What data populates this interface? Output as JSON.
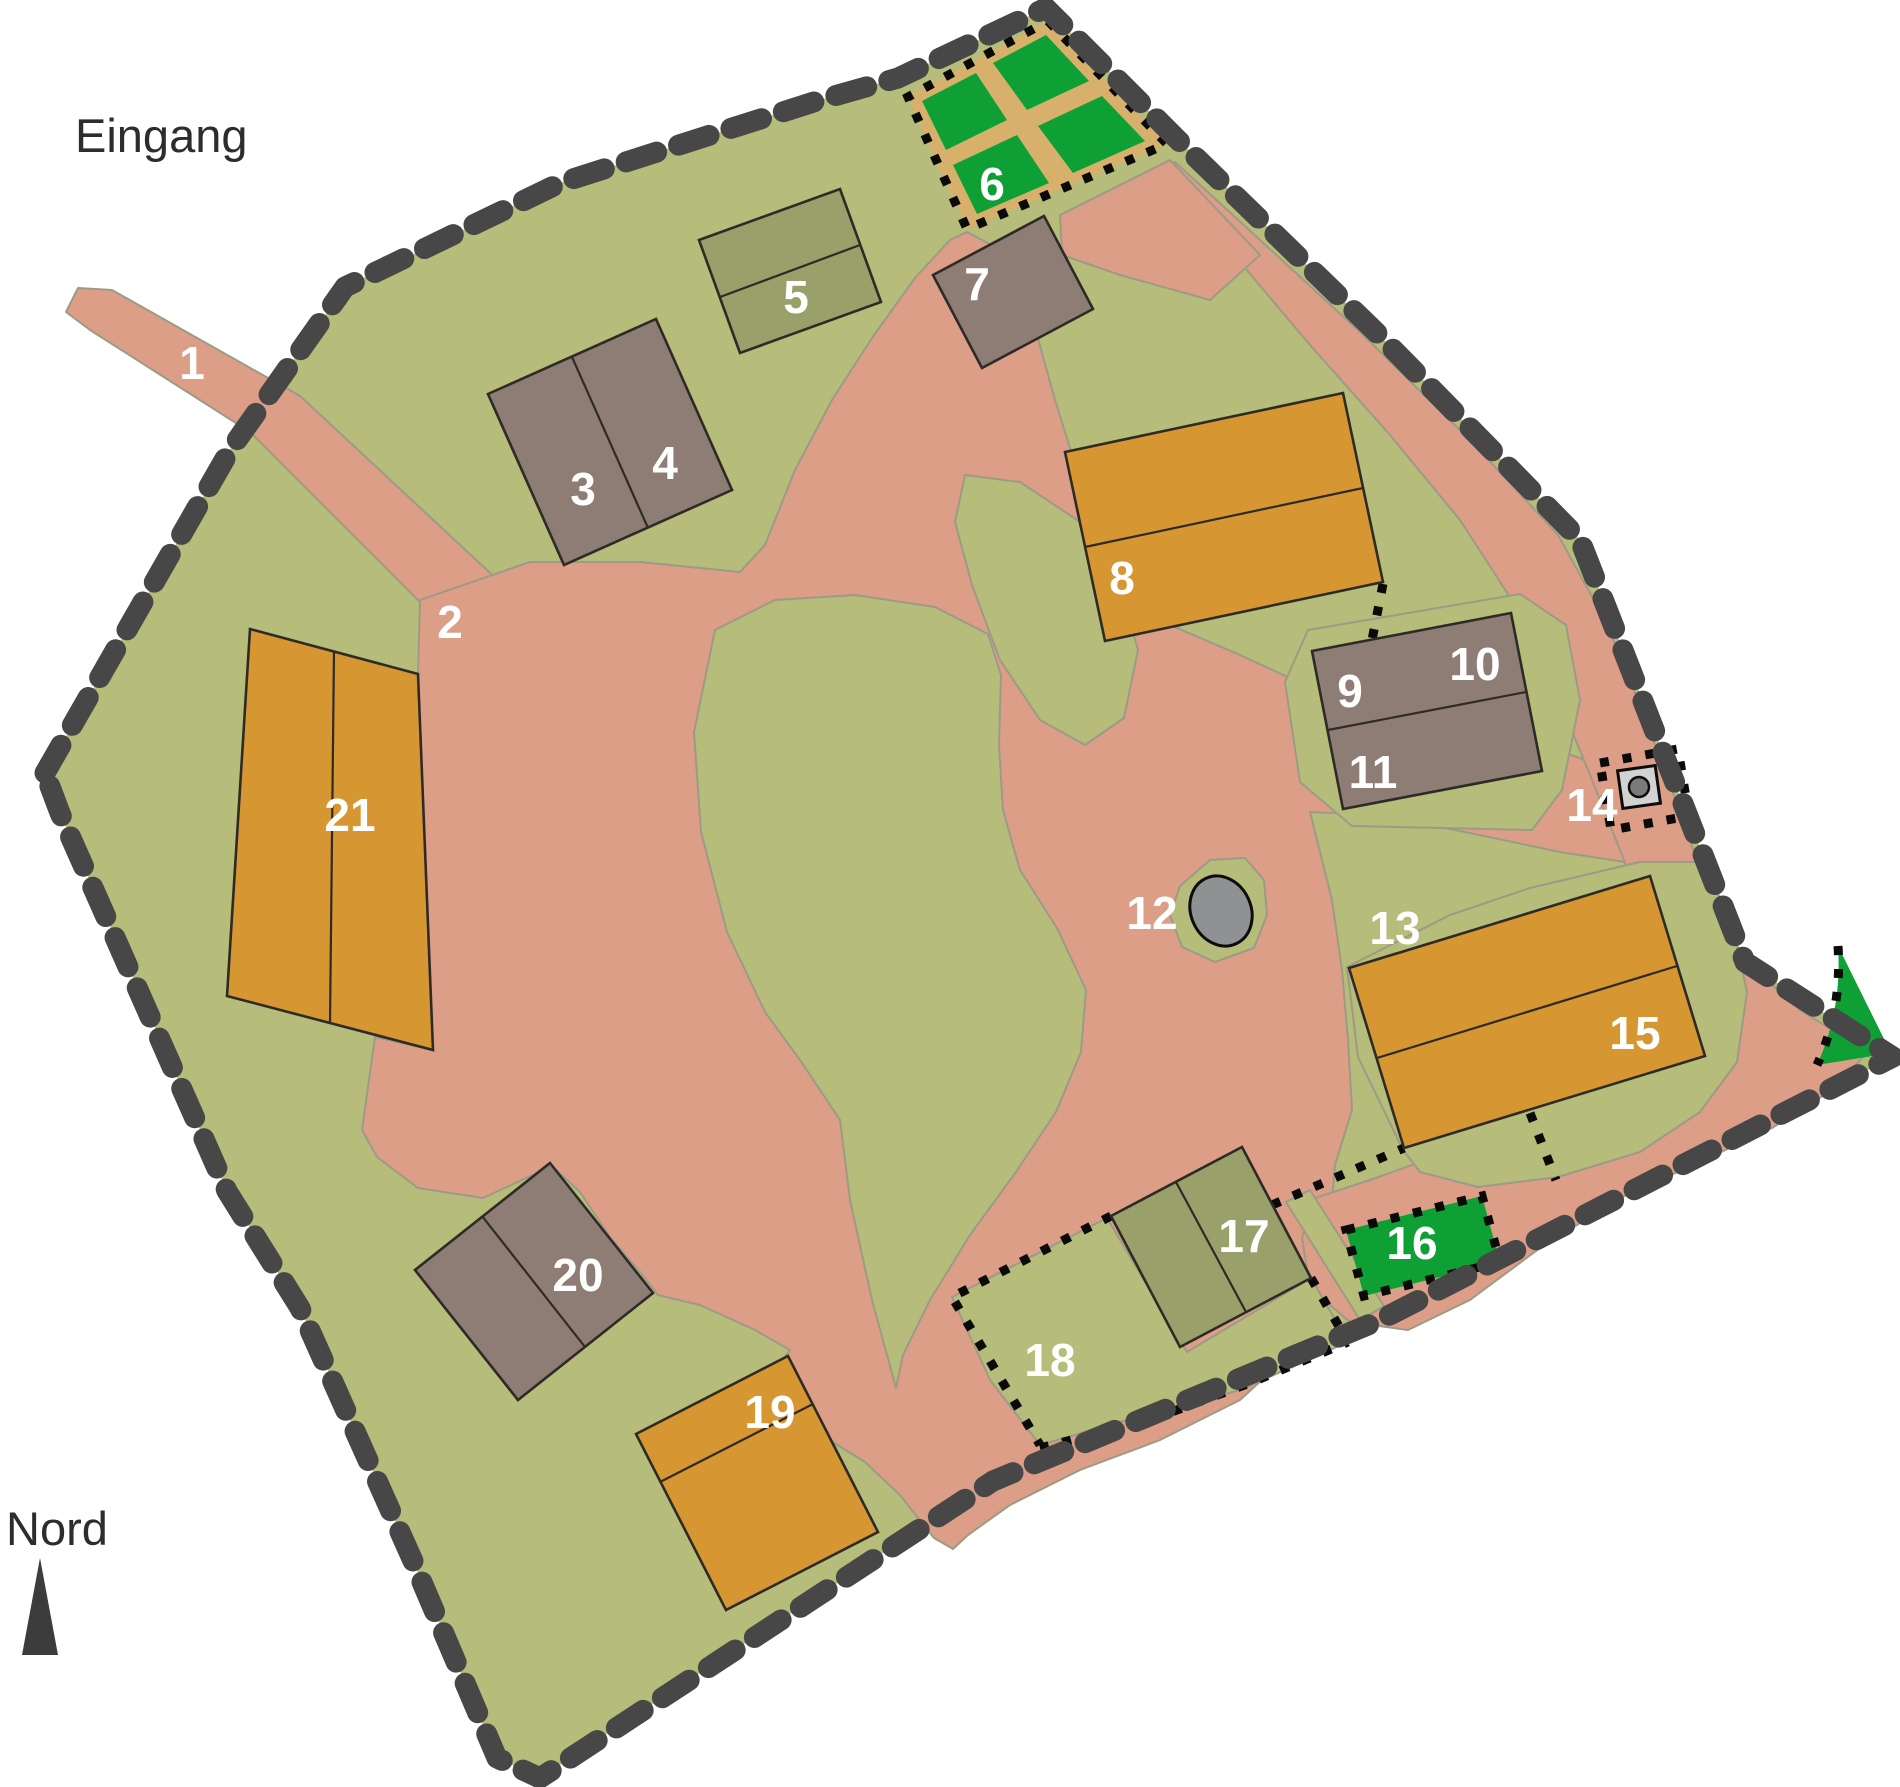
{
  "map": {
    "type": "site-plan",
    "captions": [
      {
        "id": "entrance",
        "text": "Eingang",
        "x": 75,
        "y": 152
      },
      {
        "id": "north",
        "text": "Nord",
        "x": 6,
        "y": 1545
      }
    ],
    "markers": [
      {
        "text": "1",
        "x": 192,
        "y": 363
      },
      {
        "text": "2",
        "x": 450,
        "y": 622
      },
      {
        "text": "3",
        "x": 583,
        "y": 489
      },
      {
        "text": "4",
        "x": 665,
        "y": 463
      },
      {
        "text": "5",
        "x": 796,
        "y": 297
      },
      {
        "text": "6",
        "x": 992,
        "y": 184
      },
      {
        "text": "7",
        "x": 977,
        "y": 284
      },
      {
        "text": "8",
        "x": 1122,
        "y": 578
      },
      {
        "text": "9",
        "x": 1350,
        "y": 691
      },
      {
        "text": "10",
        "x": 1475,
        "y": 664
      },
      {
        "text": "11",
        "x": 1373,
        "y": 772
      },
      {
        "text": "12",
        "x": 1152,
        "y": 913
      },
      {
        "text": "13",
        "x": 1395,
        "y": 928
      },
      {
        "text": "14",
        "x": 1592,
        "y": 805
      },
      {
        "text": "15",
        "x": 1635,
        "y": 1033
      },
      {
        "text": "16",
        "x": 1412,
        "y": 1243
      },
      {
        "text": "17",
        "x": 1244,
        "y": 1236
      },
      {
        "text": "18",
        "x": 1050,
        "y": 1360
      },
      {
        "text": "19",
        "x": 770,
        "y": 1412
      },
      {
        "text": "20",
        "x": 578,
        "y": 1275
      },
      {
        "text": "21",
        "x": 350,
        "y": 815
      }
    ]
  },
  "colors": {
    "bg": "#ffffff",
    "ground": "#b6bc79",
    "path_pink": "#dd9e88",
    "path_edge": "#9d9a86",
    "building_gray": "#8d7d75",
    "building_olive": "#9aa069",
    "building_orange": "#d69732",
    "building_stroke": "#2e2a26",
    "bright_green": "#0fa035",
    "tan": "#d7b06c",
    "pond": "#8f9193",
    "boundary": "#474747",
    "dotted": "#0a0a0a",
    "well_fill": "#d2d2d2",
    "well_circle": "#7a7a7a",
    "label": "#ffffff",
    "ink": "#2d2d2d",
    "compass": "#3c3c3c"
  }
}
